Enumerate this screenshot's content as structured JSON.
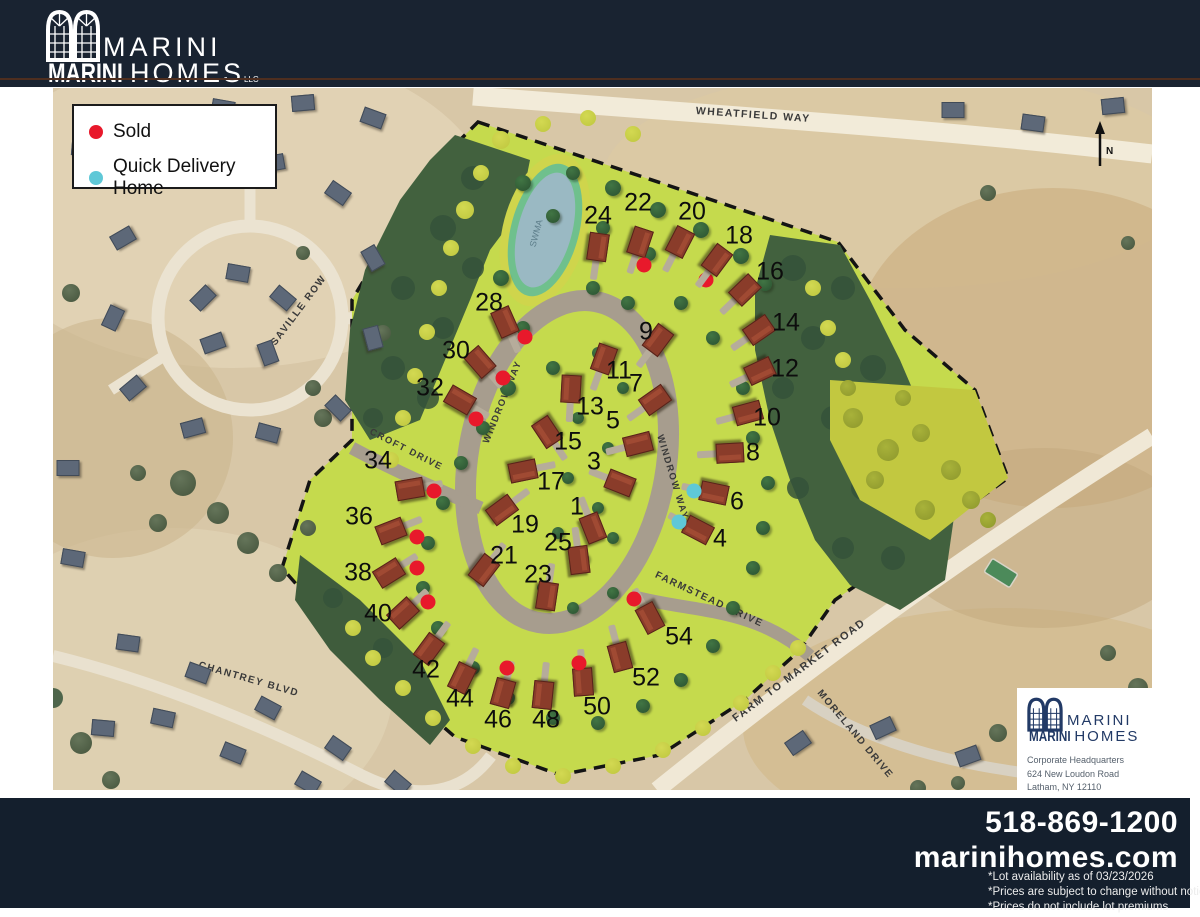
{
  "header": {
    "brand_top": "MARINI",
    "brand_bottom_left": "MARINI",
    "brand_bottom_right": "HOMES",
    "brand_suffix": "LLC"
  },
  "legend": {
    "items": [
      {
        "label": "Sold",
        "color": "#e8192b"
      },
      {
        "label": "Quick Delivery Home",
        "color": "#5fc8d7"
      }
    ]
  },
  "map": {
    "streets": {
      "wheatfield": "WHEATFIELD WAY",
      "saville": "SAVILLE ROW",
      "chantrey": "CHANTREY BLVD",
      "croft": "CROFT DRIVE",
      "windrow_left": "WINDROW WAY",
      "windrow_right": "WINDROW WAY",
      "farmstead": "FARMSTEAD DRIVE",
      "farm_to_market": "FARM TO MARKET ROAD",
      "moreland": "MORELAND DRIVE"
    },
    "pond_label": "SWMA",
    "compass": "N",
    "lots": [
      {
        "n": "24",
        "x": 545,
        "y": 128,
        "hx": 545,
        "hy": 159,
        "s": null
      },
      {
        "n": "22",
        "x": 585,
        "y": 115,
        "hx": 587,
        "hy": 154,
        "s": "sold",
        "dx": 591,
        "dy": 177
      },
      {
        "n": "20",
        "x": 639,
        "y": 124,
        "hx": 627,
        "hy": 154,
        "s": "sold",
        "dx": 653,
        "dy": 192
      },
      {
        "n": "18",
        "x": 686,
        "y": 148,
        "hx": 664,
        "hy": 172,
        "s": null
      },
      {
        "n": "16",
        "x": 717,
        "y": 184,
        "hx": 692,
        "hy": 202,
        "s": null
      },
      {
        "n": "14",
        "x": 733,
        "y": 235,
        "hx": 706,
        "hy": 242,
        "s": null
      },
      {
        "n": "12",
        "x": 732,
        "y": 281,
        "hx": 707,
        "hy": 283,
        "s": null
      },
      {
        "n": "10",
        "x": 714,
        "y": 330,
        "hx": 695,
        "hy": 325,
        "s": null
      },
      {
        "n": "8",
        "x": 700,
        "y": 365,
        "hx": 677,
        "hy": 365,
        "s": null
      },
      {
        "n": "6",
        "x": 684,
        "y": 414,
        "hx": 661,
        "hy": 405,
        "s": "quick",
        "dx": 641,
        "dy": 403
      },
      {
        "n": "4",
        "x": 667,
        "y": 451,
        "hx": 645,
        "hy": 442,
        "s": "quick",
        "dx": 626,
        "dy": 434
      },
      {
        "n": "9",
        "x": 593,
        "y": 244,
        "hx": 605,
        "hy": 252,
        "s": null,
        "inv": 1
      },
      {
        "n": "11",
        "x": 566,
        "y": 283,
        "hx": 551,
        "hy": 271,
        "s": null,
        "inv": 1
      },
      {
        "n": "7",
        "x": 583,
        "y": 296,
        "hx": 602,
        "hy": 312,
        "s": null,
        "inv": 1
      },
      {
        "n": "13",
        "x": 537,
        "y": 319,
        "hx": 518,
        "hy": 301,
        "s": null,
        "inv": 1
      },
      {
        "n": "5",
        "x": 560,
        "y": 333,
        "hx": 585,
        "hy": 356,
        "s": null,
        "inv": 1
      },
      {
        "n": "15",
        "x": 515,
        "y": 354,
        "hx": 494,
        "hy": 344,
        "s": null,
        "inv": 1
      },
      {
        "n": "3",
        "x": 541,
        "y": 374,
        "hx": 567,
        "hy": 395,
        "s": null,
        "inv": 1
      },
      {
        "n": "17",
        "x": 498,
        "y": 394,
        "hx": 470,
        "hy": 383,
        "s": null,
        "inv": 1
      },
      {
        "n": "1",
        "x": 524,
        "y": 419,
        "hx": 540,
        "hy": 440,
        "s": null,
        "inv": 1
      },
      {
        "n": "19",
        "x": 472,
        "y": 437,
        "hx": 449,
        "hy": 422,
        "s": null,
        "inv": 1
      },
      {
        "n": "25",
        "x": 505,
        "y": 455,
        "hx": 526,
        "hy": 472,
        "s": null,
        "inv": 1
      },
      {
        "n": "21",
        "x": 451,
        "y": 468,
        "hx": 431,
        "hy": 482,
        "s": null,
        "inv": 1
      },
      {
        "n": "23",
        "x": 485,
        "y": 487,
        "hx": 494,
        "hy": 508,
        "s": null,
        "inv": 1
      },
      {
        "n": "28",
        "x": 436,
        "y": 215,
        "hx": 452,
        "hy": 234,
        "s": "sold",
        "dx": 472,
        "dy": 249
      },
      {
        "n": "30",
        "x": 403,
        "y": 263,
        "hx": 427,
        "hy": 274,
        "s": "sold",
        "dx": 450,
        "dy": 290
      },
      {
        "n": "32",
        "x": 377,
        "y": 300,
        "hx": 407,
        "hy": 312,
        "s": "sold",
        "dx": 423,
        "dy": 331
      },
      {
        "n": "34",
        "x": 325,
        "y": 373,
        "hx": 357,
        "hy": 401,
        "s": "sold",
        "dx": 381,
        "dy": 403
      },
      {
        "n": "36",
        "x": 306,
        "y": 429,
        "hx": 338,
        "hy": 443,
        "s": "sold",
        "dx": 364,
        "dy": 449
      },
      {
        "n": "38",
        "x": 305,
        "y": 485,
        "hx": 336,
        "hy": 485,
        "s": "sold",
        "dx": 364,
        "dy": 480
      },
      {
        "n": "40",
        "x": 325,
        "y": 526,
        "hx": 350,
        "hy": 525,
        "s": "sold",
        "dx": 375,
        "dy": 514
      },
      {
        "n": "42",
        "x": 373,
        "y": 582,
        "hx": 376,
        "hy": 561,
        "s": null
      },
      {
        "n": "44",
        "x": 407,
        "y": 611,
        "hx": 409,
        "hy": 590,
        "s": null
      },
      {
        "n": "46",
        "x": 445,
        "y": 632,
        "hx": 450,
        "hy": 605,
        "s": "sold",
        "dx": 454,
        "dy": 580
      },
      {
        "n": "48",
        "x": 493,
        "y": 632,
        "hx": 490,
        "hy": 607,
        "s": null
      },
      {
        "n": "50",
        "x": 544,
        "y": 619,
        "hx": 530,
        "hy": 594,
        "s": "sold",
        "dx": 526,
        "dy": 575
      },
      {
        "n": "52",
        "x": 593,
        "y": 590,
        "hx": 567,
        "hy": 569,
        "s": null
      },
      {
        "n": "54",
        "x": 626,
        "y": 549,
        "hx": 597,
        "hy": 530,
        "s": "sold",
        "dx": 581,
        "dy": 511
      }
    ],
    "decor": {
      "fringe": [
        [
          448,
          52,
          9
        ],
        [
          428,
          85,
          8
        ],
        [
          412,
          122,
          9
        ],
        [
          398,
          160,
          8
        ],
        [
          386,
          200,
          8
        ],
        [
          374,
          244,
          8
        ],
        [
          362,
          288,
          8
        ],
        [
          350,
          330,
          8
        ],
        [
          338,
          372,
          8
        ],
        [
          490,
          36,
          8
        ],
        [
          535,
          30,
          8
        ],
        [
          580,
          46,
          8
        ],
        [
          760,
          200,
          8
        ],
        [
          775,
          240,
          8
        ],
        [
          790,
          272,
          8
        ],
        [
          300,
          540,
          8
        ],
        [
          320,
          570,
          8
        ],
        [
          350,
          600,
          8
        ],
        [
          380,
          630,
          8
        ],
        [
          420,
          658,
          8
        ],
        [
          460,
          678,
          8
        ],
        [
          510,
          688,
          8
        ],
        [
          560,
          678,
          8
        ],
        [
          610,
          662,
          8
        ],
        [
          650,
          640,
          8
        ],
        [
          688,
          615,
          8
        ],
        [
          720,
          585,
          8
        ],
        [
          745,
          560,
          8
        ]
      ],
      "shrubs": [
        [
          800,
          330,
          10
        ],
        [
          835,
          362,
          11
        ],
        [
          868,
          345,
          9
        ],
        [
          898,
          382,
          10
        ],
        [
          918,
          412,
          9
        ],
        [
          872,
          422,
          10
        ],
        [
          822,
          392,
          9
        ],
        [
          935,
          432,
          8
        ],
        [
          795,
          300,
          8
        ],
        [
          850,
          310,
          8
        ]
      ],
      "out_trees": [
        [
          130,
          395,
          13
        ],
        [
          165,
          425,
          11
        ],
        [
          105,
          435,
          9
        ],
        [
          195,
          455,
          11
        ],
        [
          225,
          485,
          9
        ],
        [
          85,
          385,
          8
        ],
        [
          255,
          440,
          8
        ],
        [
          28,
          655,
          11
        ],
        [
          58,
          692,
          9
        ],
        [
          945,
          645,
          9
        ],
        [
          1000,
          625,
          7
        ],
        [
          1055,
          565,
          8
        ],
        [
          1085,
          600,
          10
        ],
        [
          865,
          700,
          8
        ],
        [
          905,
          695,
          7
        ],
        [
          250,
          165,
          7
        ],
        [
          330,
          245,
          8
        ],
        [
          18,
          205,
          9
        ],
        [
          1075,
          155,
          7
        ],
        [
          935,
          105,
          8
        ],
        [
          270,
          330,
          9
        ],
        [
          260,
          300,
          8
        ]
      ],
      "gray_houses": [
        [
          185,
          185,
          10
        ],
        [
          230,
          210,
          40
        ],
        [
          215,
          265,
          70
        ],
        [
          160,
          255,
          -20
        ],
        [
          150,
          210,
          -45
        ],
        [
          150,
          85,
          15
        ],
        [
          220,
          75,
          -10
        ],
        [
          285,
          105,
          35
        ],
        [
          320,
          170,
          60
        ],
        [
          320,
          250,
          75
        ],
        [
          285,
          320,
          45
        ],
        [
          215,
          345,
          15
        ],
        [
          140,
          340,
          -15
        ],
        [
          80,
          300,
          -40
        ],
        [
          60,
          230,
          -65
        ],
        [
          70,
          150,
          -30
        ],
        [
          30,
          60,
          5
        ],
        [
          95,
          30,
          -10
        ],
        [
          170,
          20,
          10
        ],
        [
          250,
          15,
          -5
        ],
        [
          320,
          30,
          20
        ],
        [
          15,
          380,
          0
        ],
        [
          20,
          470,
          10
        ],
        [
          75,
          555,
          8
        ],
        [
          145,
          585,
          20
        ],
        [
          215,
          620,
          28
        ],
        [
          285,
          660,
          35
        ],
        [
          345,
          695,
          40
        ],
        [
          110,
          630,
          12
        ],
        [
          180,
          665,
          22
        ],
        [
          255,
          695,
          30
        ],
        [
          50,
          640,
          5
        ],
        [
          745,
          655,
          -35
        ],
        [
          830,
          640,
          -25
        ],
        [
          915,
          668,
          -20
        ],
        [
          990,
          692,
          -15
        ],
        [
          1065,
          640,
          -10
        ],
        [
          900,
          22,
          0
        ],
        [
          980,
          35,
          8
        ],
        [
          1060,
          18,
          -6
        ]
      ],
      "site_trees": [
        [
          470,
          95,
          8
        ],
        [
          520,
          85,
          7
        ],
        [
          560,
          100,
          8
        ],
        [
          605,
          122,
          8
        ],
        [
          648,
          142,
          8
        ],
        [
          688,
          168,
          8
        ],
        [
          712,
          196,
          7
        ],
        [
          596,
          166,
          7
        ],
        [
          550,
          140,
          7
        ],
        [
          500,
          128,
          7
        ],
        [
          448,
          190,
          8
        ],
        [
          470,
          240,
          7
        ],
        [
          500,
          280,
          7
        ],
        [
          455,
          300,
          8
        ],
        [
          430,
          340,
          7
        ],
        [
          408,
          375,
          7
        ],
        [
          390,
          415,
          7
        ],
        [
          375,
          455,
          7
        ],
        [
          370,
          500,
          7
        ],
        [
          385,
          540,
          7
        ],
        [
          420,
          580,
          7
        ],
        [
          455,
          610,
          7
        ],
        [
          500,
          630,
          7
        ],
        [
          545,
          635,
          7
        ],
        [
          590,
          618,
          7
        ],
        [
          628,
          592,
          7
        ],
        [
          660,
          558,
          7
        ],
        [
          680,
          520,
          7
        ],
        [
          700,
          480,
          7
        ],
        [
          710,
          440,
          7
        ],
        [
          715,
          395,
          7
        ],
        [
          700,
          350,
          7
        ],
        [
          690,
          300,
          7
        ],
        [
          660,
          250,
          7
        ],
        [
          628,
          215,
          7
        ],
        [
          540,
          200,
          7
        ],
        [
          575,
          215,
          7
        ],
        [
          545,
          265,
          6
        ],
        [
          570,
          300,
          6
        ],
        [
          525,
          330,
          6
        ],
        [
          555,
          360,
          6
        ],
        [
          515,
          390,
          6
        ],
        [
          545,
          420,
          6
        ],
        [
          505,
          445,
          6
        ],
        [
          530,
          470,
          6
        ],
        [
          560,
          450,
          6
        ],
        [
          490,
          500,
          6
        ],
        [
          520,
          520,
          6
        ],
        [
          560,
          505,
          6
        ]
      ]
    }
  },
  "corporate": {
    "line1": "Corporate Headquarters",
    "line2": "624 New Loudon Road",
    "line3": "Latham, NY 12110"
  },
  "footer": {
    "phone": "518-869-1200",
    "website": "marinihomes.com",
    "notes": [
      "*Lot availability as of 03/23/2026",
      "*Prices are subject to change without notice",
      "*Prices do not include lot premiums"
    ]
  }
}
